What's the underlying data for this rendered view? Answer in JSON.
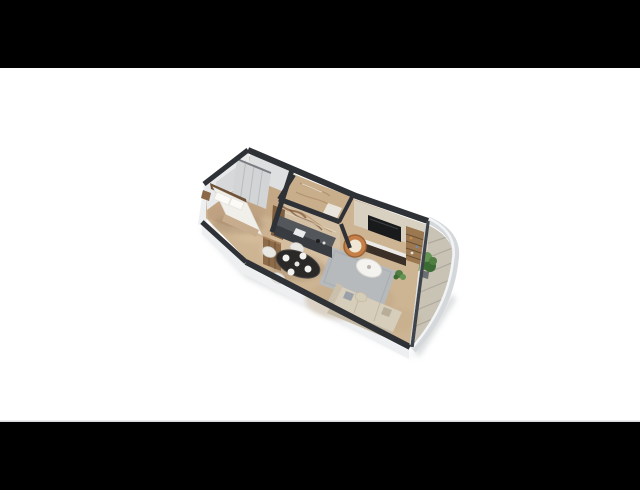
{
  "scene": {
    "description": "3D isometric floor plan render of a one-bedroom apartment, letterboxed on white",
    "canvas_width": 640,
    "canvas_height": 490,
    "letterbox_top_height": 68,
    "letterbox_bottom_height": 68
  },
  "palette": {
    "background": "#ffffff",
    "letterbox": "#000000",
    "frame_line": "#cbced1",
    "shadow": "#aeb2b5",
    "wall_cap": "#2e3236",
    "window_frame": "#3f444a",
    "glass": "#ced6d9",
    "wall_face_exterior": "#edeff1",
    "wall_face_interior": "#e8e9eb",
    "bedroom_wall_face": "#dddfe0",
    "headboard_wall": "#d6d8d9",
    "floor_main": "#cdb493",
    "floor_bedroom": "#c3a584",
    "rug": "#b7babd",
    "balcony_floor": "#c8c3b5",
    "tile_joint": "#a8a398",
    "railing": "#d5d8da",
    "railing_highlight": "#f2f4f5",
    "bathroom_stone": "#c9ae8c",
    "marble_base": "#d3bfa3",
    "marble_vein": "#7c5130",
    "kitchen_counter_top": "#53575b",
    "kitchen_counter_front": "#383c40",
    "kitchen_wood": "#7d5e3f",
    "wardrobe": "#d2d4d6",
    "wardrobe_line": "#b9bcbe",
    "bed_duvet": "#f1efe9",
    "headboard": "#6e5238",
    "blanket": "#c7ad8e",
    "pillow": "#fbfaf7",
    "nightstand": "#8a6848",
    "dining_table": "#2b2927",
    "chair": "#e8e7e2",
    "plate": "#f3f2ef",
    "sofa": "#d6cdba",
    "sofa_back": "#c4b9a4",
    "pouf": "#d6cdb9",
    "coffee_table": "#f4f3f0",
    "copper_chair": "#c58049",
    "copper_cushion": "#efe7d4",
    "tv": "#191a1c",
    "tv_wall": "#d8d1c2",
    "console_top": "#eceae6",
    "console_body": "#3a3028",
    "shelf_wood": "#9c7850",
    "shelf_line": "#6b5134",
    "wood_cabinet": "#8d6b48",
    "plant_green": "#4f7d42",
    "plant_green_light": "#639454",
    "plant_green_dark": "#3c6a33",
    "pot": "#6b6f72"
  },
  "rooms": [
    {
      "id": "bedroom",
      "contents": [
        "double-bed",
        "headboard",
        "pillows",
        "blanket",
        "wardrobe",
        "nightstand"
      ]
    },
    {
      "id": "bathroom",
      "contents": [
        "stone-walls",
        "marble-feature-wall",
        "shower"
      ]
    },
    {
      "id": "kitchen",
      "contents": [
        "counter-run",
        "sink",
        "tall-wood-unit"
      ]
    },
    {
      "id": "entry-hall",
      "contents": [
        "tall-wood-cabinet"
      ]
    },
    {
      "id": "dining-area",
      "contents": [
        "oval-table",
        "four-chairs",
        "four-place-settings"
      ]
    },
    {
      "id": "living-room",
      "contents": [
        "tv-wall",
        "media-console",
        "shelving-unit",
        "copper-lounge-chair",
        "coffee-table",
        "rug",
        "sofa",
        "pouf",
        "floor-plant"
      ]
    },
    {
      "id": "balcony",
      "contents": [
        "tile-floor",
        "glass-railing",
        "potted-plant"
      ]
    }
  ]
}
